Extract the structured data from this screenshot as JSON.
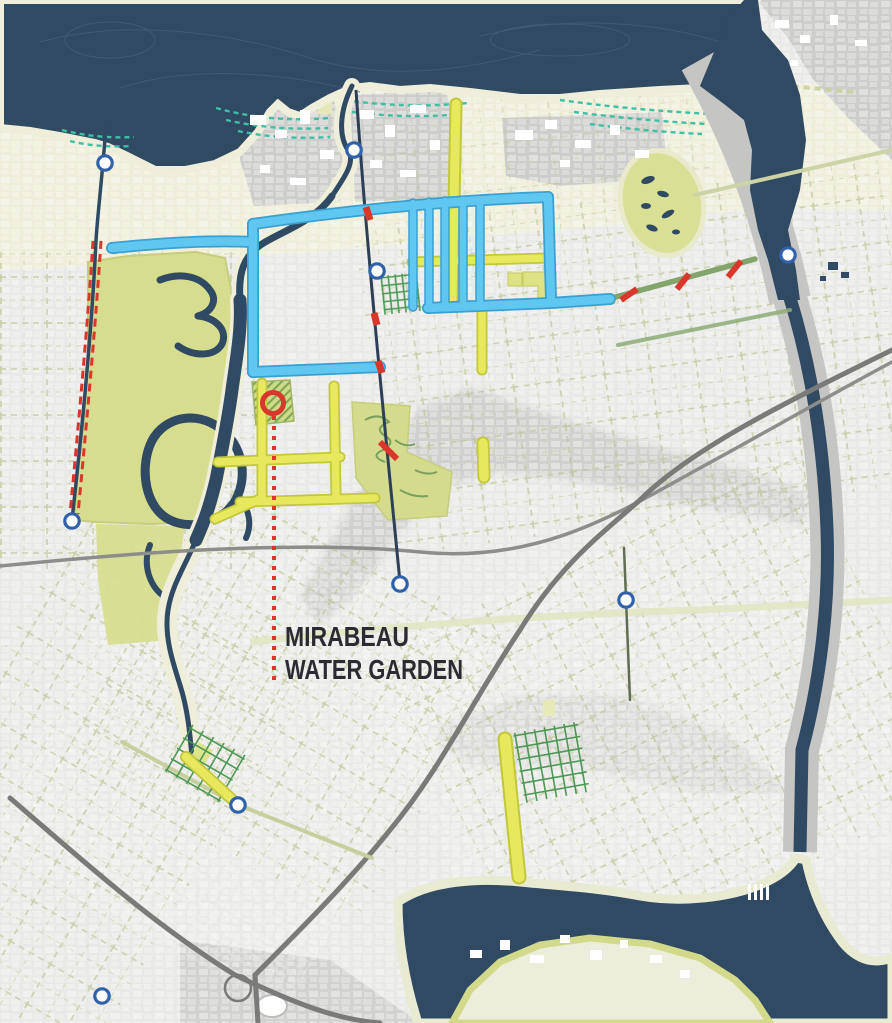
{
  "map": {
    "label": {
      "line1": "MIRABEAU",
      "line2": "WATER GARDEN"
    },
    "colors": {
      "water_navy": "#2f4a62",
      "land_gray": "#e9e9e7",
      "lakefront_cream": "#efeeda",
      "park_green": "#d7dd8f",
      "marsh_teal": "#3ec0a6",
      "water_corridor_blue": "#5fc8f0",
      "greenway_yellow": "#e7e85e",
      "boulevard_green": "#83a56b",
      "highlight_red": "#da372c",
      "node_ring_blue": "#2f62ab"
    },
    "markers": {
      "site_circle": {
        "x": 273,
        "y": 403
      },
      "nodes": [
        {
          "x": 105,
          "y": 163
        },
        {
          "x": 354,
          "y": 150
        },
        {
          "x": 377,
          "y": 271
        },
        {
          "x": 72,
          "y": 521
        },
        {
          "x": 400,
          "y": 584
        },
        {
          "x": 626,
          "y": 600
        },
        {
          "x": 788,
          "y": 255
        },
        {
          "x": 238,
          "y": 805
        },
        {
          "x": 102,
          "y": 996
        }
      ],
      "red_ticks": 7,
      "red_dashed_lines": 2
    }
  }
}
